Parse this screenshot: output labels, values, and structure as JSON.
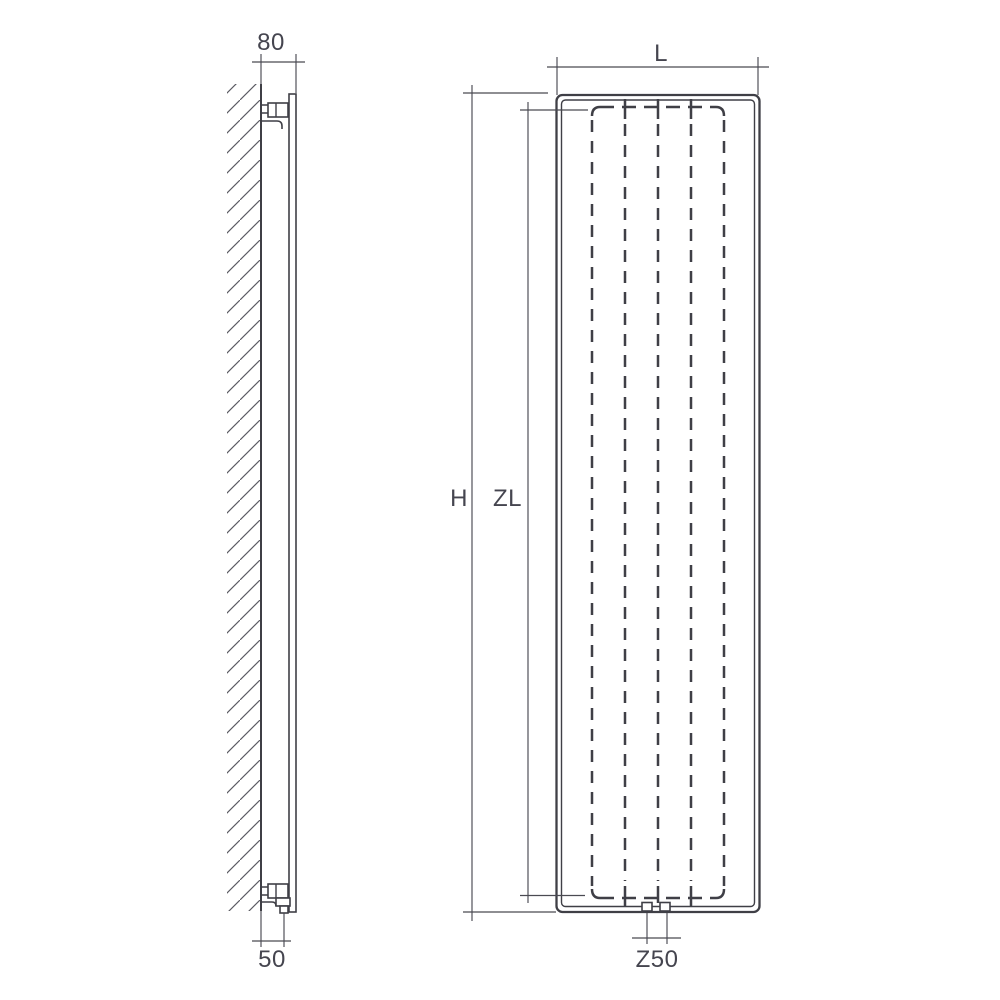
{
  "page": {
    "background": "#ffffff",
    "description": "Technical dimension drawing of a vertical panel radiator: wall-mounted side profile (left) and front elevation (right)"
  },
  "colors": {
    "line": "#3f3f46",
    "dim": "#4a4a52",
    "text": "#45454f",
    "bg": "#ffffff"
  },
  "labels": {
    "top_depth": "80",
    "bottom_depth": "50",
    "width": "L",
    "height": "H",
    "connection_length": "ZL",
    "connection_spacing": "Z50"
  }
}
